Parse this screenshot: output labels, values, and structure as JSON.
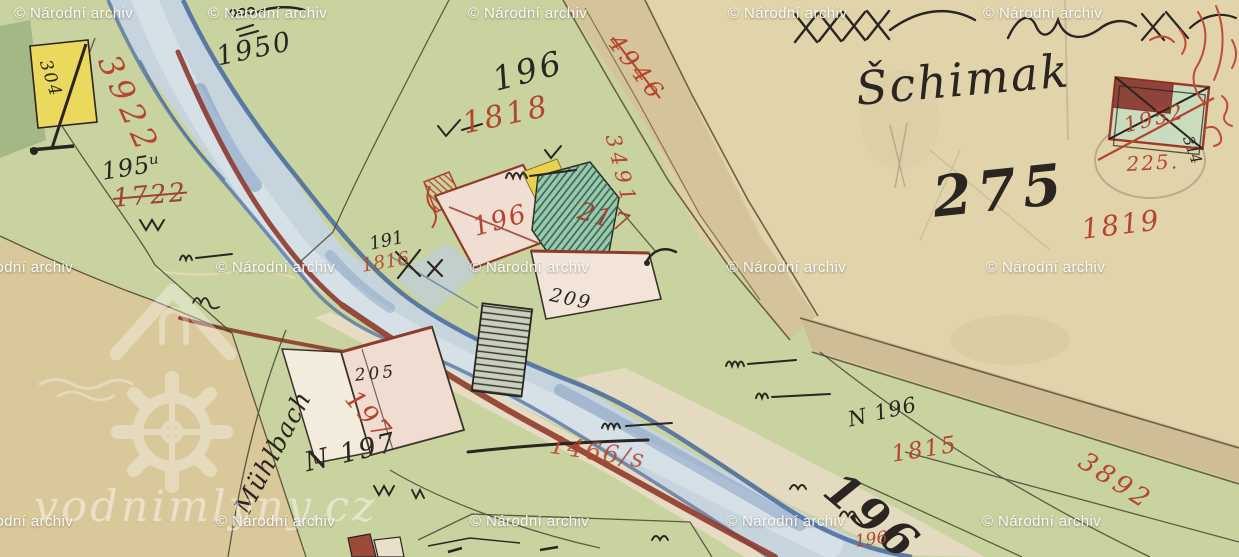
{
  "title": "Historical cadastral water-mill map scan",
  "watermark": {
    "archive": "© Národní archiv",
    "site": "vodnimlyny.cz"
  },
  "colors": {
    "red_ink": "#b5452e",
    "black_ink": "#2a2520",
    "water": "#c6d4de",
    "meadow": "#c9d3a0",
    "parchment": "#ddcfa2",
    "maroon_line": "#8e3b2c"
  },
  "labels": {
    "house_304": "304",
    "river_3922": "3922",
    "parcel_1950": "1950",
    "parcel_195u": "195ᵘ",
    "parcel_1722": "1722",
    "parcel_196": "196",
    "parcel_1818": "1818",
    "parcel_191": "191",
    "parcel_1816": "1816",
    "mill_196": "196",
    "house_209": "209",
    "parcel_217": "217",
    "road_3491": "3491",
    "road_4946": "4946",
    "name_schimak": "Šchimak",
    "parcel_275": "275",
    "parcel_1819": "1819",
    "house_1952": "1952",
    "house_225": "225.",
    "house_314": "314",
    "house_205": "205",
    "house_197": "197",
    "label_n197": "N 197",
    "label_n196": "N 196",
    "parcel_1815": "1815",
    "parcel_196_big": "196",
    "parcel_196_small": "196",
    "road_3892": "3892",
    "crossed_1466": "1466/s",
    "name_muhlbach": "Mühlbach"
  }
}
